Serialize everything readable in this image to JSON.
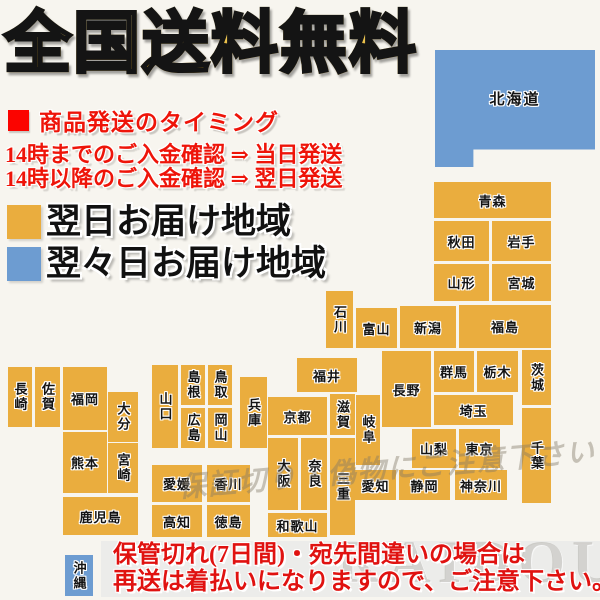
{
  "title": "全国送料無料",
  "shipping_info": {
    "heading": "商品発送のタイミング",
    "line1": "14時までのご入金確認 ⇒ 当日発送",
    "line2": "14時以降のご入金確認 ⇒ 翌日発送"
  },
  "legend": [
    {
      "label": "翌日お届け地域",
      "color": "#eaad3e"
    },
    {
      "label": "翌々日お届け地域",
      "color": "#6d9cd1"
    }
  ],
  "notice": {
    "line1": "保管切れ(7日間)・宛先間違いの場合は",
    "line2": "再送は着払いになりますので、ご注意下さい。"
  },
  "watermarks": {
    "map_text": "保証切り・偽物にご注意下さい",
    "brand": "RAIDOU"
  },
  "colors": {
    "orange": "#eaad3e",
    "blue": "#6d9cd1",
    "background": "#f7f5ef",
    "red": "#ee1409",
    "band_gray": "#ececea"
  },
  "map": {
    "regions": [
      {
        "name": "北海道",
        "x": 435,
        "y": 50,
        "w": 160,
        "h": 117,
        "color": "blue",
        "vertical": false,
        "shape": "hokkaido"
      },
      {
        "name": "青森",
        "x": 434,
        "y": 182,
        "w": 117,
        "h": 36,
        "color": "orange",
        "vertical": false
      },
      {
        "name": "秋田",
        "x": 434,
        "y": 221,
        "w": 55,
        "h": 40,
        "color": "orange",
        "vertical": false
      },
      {
        "name": "岩手",
        "x": 492,
        "y": 221,
        "w": 59,
        "h": 40,
        "color": "orange",
        "vertical": false
      },
      {
        "name": "山形",
        "x": 434,
        "y": 264,
        "w": 55,
        "h": 37,
        "color": "orange",
        "vertical": false
      },
      {
        "name": "宮城",
        "x": 492,
        "y": 264,
        "w": 59,
        "h": 37,
        "color": "orange",
        "vertical": false
      },
      {
        "name": "石川",
        "x": 326,
        "y": 291,
        "w": 27,
        "h": 57,
        "color": "orange",
        "vertical": true
      },
      {
        "name": "富山",
        "x": 356,
        "y": 308,
        "w": 41,
        "h": 40,
        "color": "orange",
        "vertical": false
      },
      {
        "name": "新潟",
        "x": 400,
        "y": 306,
        "w": 56,
        "h": 42,
        "color": "orange",
        "vertical": false
      },
      {
        "name": "福島",
        "x": 459,
        "y": 305,
        "w": 92,
        "h": 43,
        "color": "orange",
        "vertical": false
      },
      {
        "name": "群馬",
        "x": 434,
        "y": 351,
        "w": 40,
        "h": 41,
        "color": "orange",
        "vertical": false
      },
      {
        "name": "栃木",
        "x": 477,
        "y": 351,
        "w": 41,
        "h": 41,
        "color": "orange",
        "vertical": false
      },
      {
        "name": "茨城",
        "x": 522,
        "y": 350,
        "w": 29,
        "h": 55,
        "color": "orange",
        "vertical": true
      },
      {
        "name": "福井",
        "x": 297,
        "y": 358,
        "w": 60,
        "h": 34,
        "color": "orange",
        "vertical": false
      },
      {
        "name": "長野",
        "x": 382,
        "y": 351,
        "w": 49,
        "h": 76,
        "color": "orange",
        "vertical": false
      },
      {
        "name": "岐阜",
        "x": 356,
        "y": 395,
        "w": 24,
        "h": 70,
        "color": "orange",
        "vertical": true
      },
      {
        "name": "埼玉",
        "x": 434,
        "y": 395,
        "w": 79,
        "h": 30,
        "color": "orange",
        "vertical": false
      },
      {
        "name": "山梨",
        "x": 412,
        "y": 429,
        "w": 44,
        "h": 39,
        "color": "orange",
        "vertical": false
      },
      {
        "name": "東京",
        "x": 459,
        "y": 429,
        "w": 41,
        "h": 39,
        "color": "orange",
        "vertical": false
      },
      {
        "name": "千葉",
        "x": 522,
        "y": 408,
        "w": 29,
        "h": 95,
        "color": "orange",
        "vertical": true
      },
      {
        "name": "神奈川",
        "x": 455,
        "y": 470,
        "w": 52,
        "h": 30,
        "color": "orange",
        "vertical": false
      },
      {
        "name": "静岡",
        "x": 399,
        "y": 470,
        "w": 51,
        "h": 30,
        "color": "orange",
        "vertical": false
      },
      {
        "name": "愛知",
        "x": 355,
        "y": 470,
        "w": 41,
        "h": 30,
        "color": "orange",
        "vertical": false
      },
      {
        "name": "滋賀",
        "x": 330,
        "y": 394,
        "w": 25,
        "h": 41,
        "color": "orange",
        "vertical": true
      },
      {
        "name": "京都",
        "x": 268,
        "y": 397,
        "w": 59,
        "h": 38,
        "color": "orange",
        "vertical": false
      },
      {
        "name": "兵庫",
        "x": 240,
        "y": 377,
        "w": 27,
        "h": 71,
        "color": "orange",
        "vertical": true
      },
      {
        "name": "大阪",
        "x": 268,
        "y": 438,
        "w": 30,
        "h": 72,
        "color": "orange",
        "vertical": true
      },
      {
        "name": "奈良",
        "x": 301,
        "y": 438,
        "w": 26,
        "h": 72,
        "color": "orange",
        "vertical": true
      },
      {
        "name": "三重",
        "x": 330,
        "y": 438,
        "w": 25,
        "h": 97,
        "color": "orange",
        "vertical": true
      },
      {
        "name": "和歌山",
        "x": 268,
        "y": 513,
        "w": 59,
        "h": 24,
        "color": "orange",
        "vertical": false
      },
      {
        "name": "山口",
        "x": 152,
        "y": 365,
        "w": 26,
        "h": 83,
        "color": "orange",
        "vertical": true
      },
      {
        "name": "島根",
        "x": 181,
        "y": 365,
        "w": 24,
        "h": 40,
        "color": "orange",
        "vertical": true
      },
      {
        "name": "鳥取",
        "x": 208,
        "y": 365,
        "w": 24,
        "h": 40,
        "color": "orange",
        "vertical": true
      },
      {
        "name": "広島",
        "x": 181,
        "y": 408,
        "w": 24,
        "h": 40,
        "color": "orange",
        "vertical": true
      },
      {
        "name": "岡山",
        "x": 208,
        "y": 408,
        "w": 24,
        "h": 40,
        "color": "orange",
        "vertical": true
      },
      {
        "name": "愛媛",
        "x": 152,
        "y": 465,
        "w": 50,
        "h": 37,
        "color": "orange",
        "vertical": false
      },
      {
        "name": "香川",
        "x": 207,
        "y": 465,
        "w": 43,
        "h": 37,
        "color": "orange",
        "vertical": false
      },
      {
        "name": "高知",
        "x": 152,
        "y": 505,
        "w": 50,
        "h": 32,
        "color": "orange",
        "vertical": false
      },
      {
        "name": "徳島",
        "x": 207,
        "y": 505,
        "w": 43,
        "h": 32,
        "color": "orange",
        "vertical": false
      },
      {
        "name": "長崎",
        "x": 8,
        "y": 367,
        "w": 24,
        "h": 60,
        "color": "orange",
        "vertical": true
      },
      {
        "name": "佐賀",
        "x": 35,
        "y": 367,
        "w": 25,
        "h": 60,
        "color": "orange",
        "vertical": true
      },
      {
        "name": "福岡",
        "x": 63,
        "y": 367,
        "w": 44,
        "h": 63,
        "color": "orange",
        "vertical": false
      },
      {
        "name": "大分",
        "x": 108,
        "y": 392,
        "w": 30,
        "h": 50,
        "color": "orange",
        "vertical": true
      },
      {
        "name": "熊本",
        "x": 63,
        "y": 432,
        "w": 44,
        "h": 61,
        "color": "orange",
        "vertical": false
      },
      {
        "name": "宮崎",
        "x": 108,
        "y": 443,
        "w": 30,
        "h": 50,
        "color": "orange",
        "vertical": true
      },
      {
        "name": "鹿児島",
        "x": 63,
        "y": 497,
        "w": 75,
        "h": 38,
        "color": "orange",
        "vertical": false
      },
      {
        "name": "沖縄",
        "x": 65,
        "y": 555,
        "w": 28,
        "h": 41,
        "color": "blue",
        "vertical": true
      }
    ]
  }
}
